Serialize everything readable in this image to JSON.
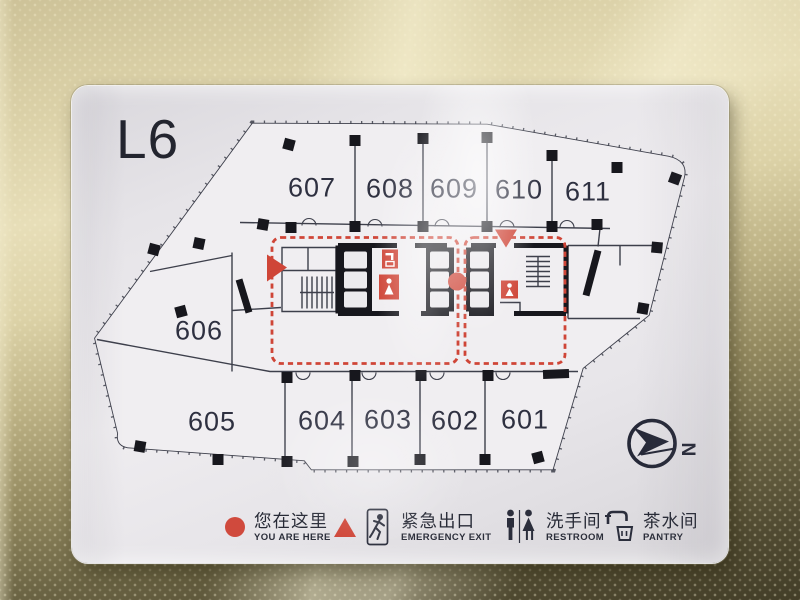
{
  "sign": {
    "floor_label": "L6"
  },
  "plan": {
    "rooms": [
      {
        "label": "607"
      },
      {
        "label": "608"
      },
      {
        "label": "609"
      },
      {
        "label": "610"
      },
      {
        "label": "611"
      },
      {
        "label": "606"
      },
      {
        "label": "605"
      },
      {
        "label": "604"
      },
      {
        "label": "603"
      },
      {
        "label": "602"
      },
      {
        "label": "601"
      }
    ],
    "markers": {
      "you_are_here": "red-dot",
      "emergency_exits": "red-triangles",
      "escape_route": "red-dashed-loop"
    }
  },
  "legend": {
    "items": [
      {
        "zh": "您在这里",
        "en": "YOU ARE HERE",
        "icon": "you-are-here-dot"
      },
      {
        "zh": "紧急出口",
        "en": "EMERGENCY EXIT",
        "icon": "running-man-exit-icon"
      },
      {
        "zh": "洗手间",
        "en": "RESTROOM",
        "icon": "restroom-figures-icon"
      },
      {
        "zh": "茶水间",
        "en": "PANTRY",
        "icon": "faucet-cup-icon"
      }
    ]
  },
  "compass": {
    "north_label": "N"
  },
  "colors": {
    "accent_red": "#cf4537",
    "plan_line": "#3d3f4b",
    "wall_black": "#17171d",
    "wall_gold": "#d8cda2",
    "wall_dark_olive": "#48422c",
    "panel_white": "#eceaed",
    "text_navy": "#272a36"
  }
}
